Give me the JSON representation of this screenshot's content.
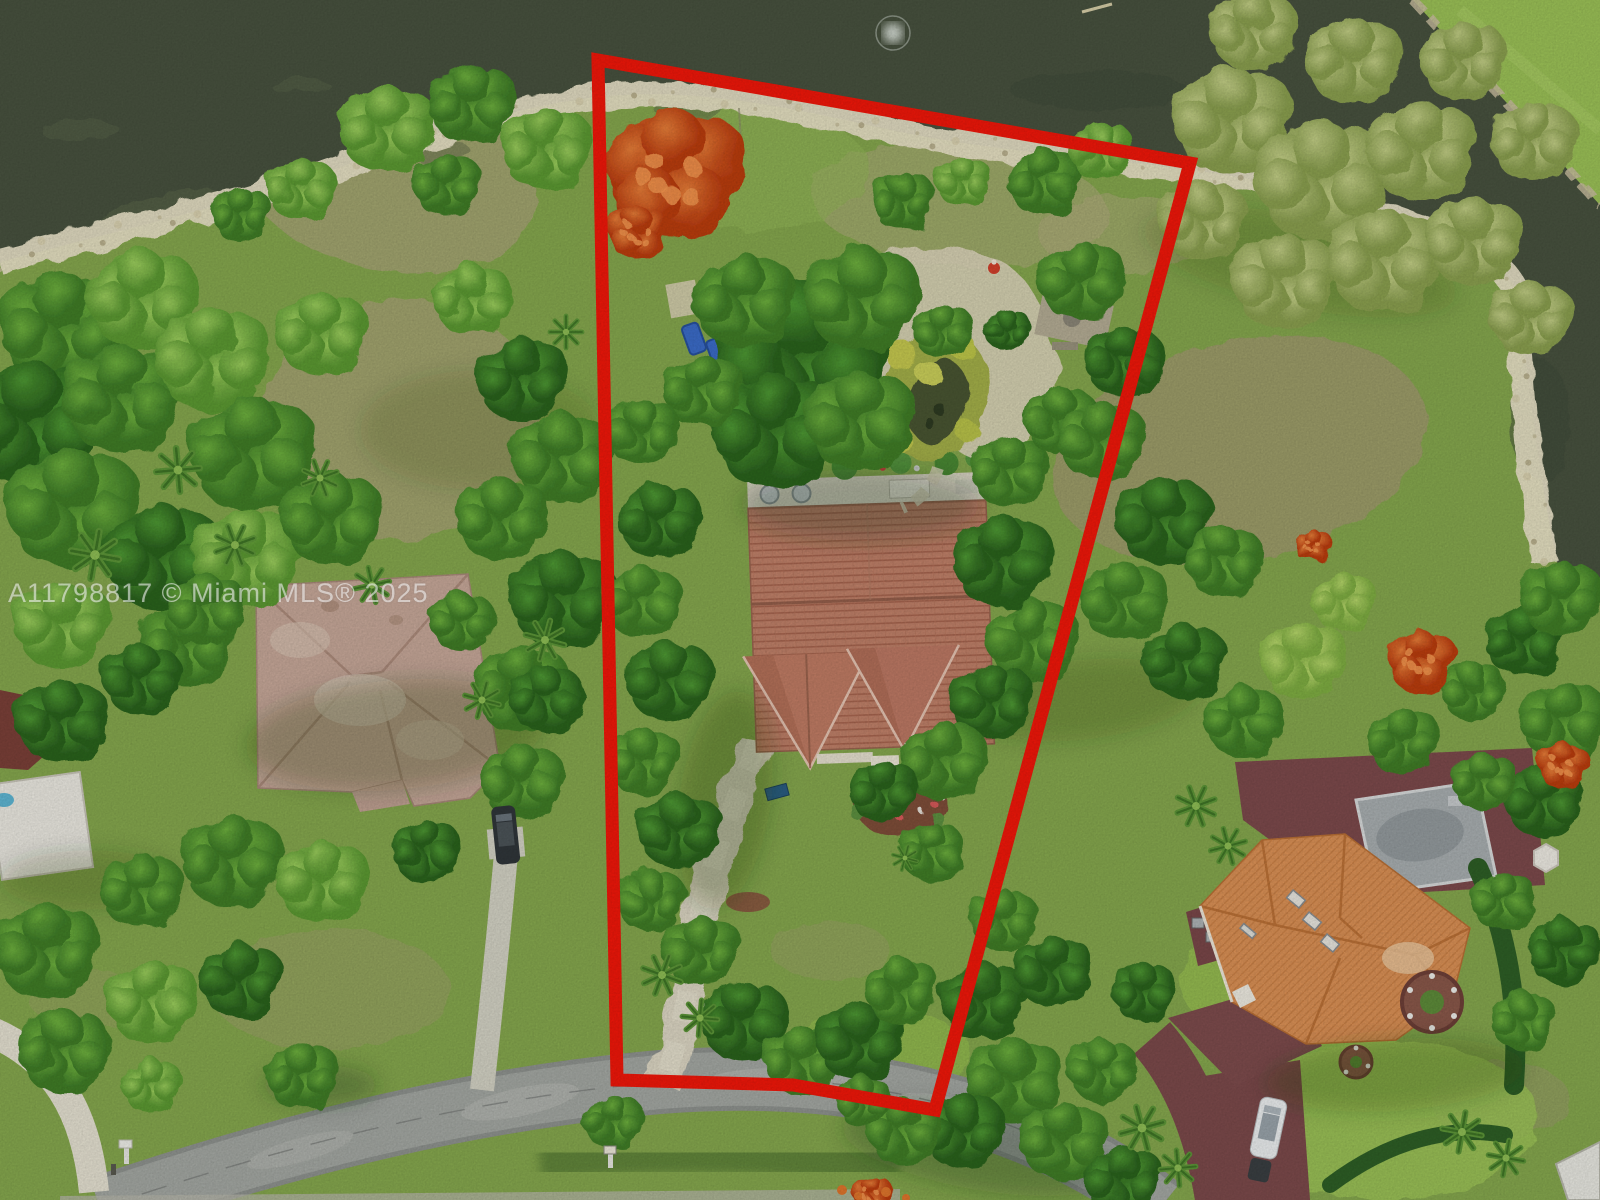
{
  "image": {
    "description": "Aerial drone photo of a pie-shaped residential lot outlined in red, fronting a dark lake at top with a sandy shoreline, a tile-roof house and tropical garden inside the boundary, neighboring homes to the left and lower right, and a curving street along the bottom"
  },
  "watermark": {
    "text": "A11798817 © Miami MLS® 2025",
    "color": "rgba(255,255,255,0.55)"
  },
  "boundary": {
    "points": "598,60 1190,163 935,1110 793,1085 617,1080",
    "color": "#f2170a",
    "stroke_width": 13
  },
  "colors": {
    "water": "#48523f",
    "shore_sand": "#eae3c8",
    "grass": "#86a84e",
    "dry_grass": "#a9a478",
    "road": "#a4a8a3",
    "concrete_drive": "#ddd7c4",
    "maroon_paving": "#7d4a4c",
    "subject_roof": "#c08169",
    "left_roof": "#c7a899",
    "right_roof": "#db9156",
    "boundary_red": "#f2170a",
    "poinciana_orange": "#d4541e"
  },
  "scene": {
    "labels": [
      {
        "name": "lake",
        "description": "dark olive lake across the top with aerator fountain"
      },
      {
        "name": "shoreline",
        "description": "white sandy rocky shoreline strip"
      },
      {
        "name": "subject-lot",
        "description": "red outlined pie-shaped waterfront lot"
      },
      {
        "name": "subject-house",
        "description": "terracotta barrel-tile roof house with two front gables"
      },
      {
        "name": "garden-pond",
        "description": "koi pond with white gravel paths in rear garden"
      },
      {
        "name": "left-house",
        "description": "neighbor house with faded pink hip roof"
      },
      {
        "name": "right-house",
        "description": "neighbor house with bright orange tile roof, flat gray roof and maroon pavers"
      },
      {
        "name": "street",
        "description": "gray asphalt road curving along the bottom"
      },
      {
        "name": "white-car",
        "description": "white car on maroon driveway lower right"
      },
      {
        "name": "dark-car",
        "description": "dark car on left neighbor driveway"
      }
    ],
    "trees": [
      [
        60,
        330,
        55,
        2
      ],
      [
        140,
        300,
        48,
        3
      ],
      [
        30,
        425,
        60,
        1
      ],
      [
        120,
        400,
        52,
        2
      ],
      [
        210,
        360,
        50,
        3
      ],
      [
        70,
        510,
        58,
        2
      ],
      [
        160,
        560,
        52,
        1
      ],
      [
        250,
        455,
        55,
        2
      ],
      [
        245,
        560,
        48,
        3
      ],
      [
        330,
        520,
        44,
        2
      ],
      [
        320,
        335,
        40,
        3
      ],
      [
        185,
        645,
        40,
        2
      ],
      [
        60,
        625,
        42,
        3
      ],
      [
        385,
        130,
        42,
        3
      ],
      [
        470,
        105,
        38,
        2
      ],
      [
        545,
        150,
        40,
        3
      ],
      [
        300,
        190,
        30,
        3
      ],
      [
        240,
        215,
        26,
        2
      ],
      [
        445,
        185,
        30,
        2
      ],
      [
        520,
        380,
        40,
        1
      ],
      [
        560,
        460,
        44,
        2
      ],
      [
        500,
        520,
        40,
        2
      ],
      [
        560,
        600,
        46,
        1
      ],
      [
        520,
        690,
        42,
        2
      ],
      [
        470,
        300,
        34,
        3
      ],
      [
        205,
        610,
        34,
        2
      ],
      [
        140,
        680,
        34,
        1
      ],
      [
        230,
        862,
        44,
        2
      ],
      [
        320,
        882,
        40,
        3
      ],
      [
        140,
        892,
        36,
        2
      ],
      [
        425,
        852,
        30,
        1
      ],
      [
        520,
        782,
        36,
        2
      ],
      [
        545,
        700,
        32,
        1
      ],
      [
        460,
        622,
        28,
        2
      ],
      [
        60,
        722,
        40,
        1
      ],
      [
        45,
        952,
        46,
        2
      ],
      [
        150,
        1002,
        40,
        3
      ],
      [
        62,
        1052,
        40,
        2
      ],
      [
        240,
        982,
        36,
        1
      ],
      [
        300,
        1076,
        32,
        2
      ],
      [
        150,
        1086,
        26,
        3
      ],
      [
        800,
        360,
        75,
        1
      ],
      [
        860,
        300,
        50,
        2
      ],
      [
        742,
        302,
        45,
        2
      ],
      [
        772,
        432,
        55,
        1
      ],
      [
        858,
        422,
        48,
        2
      ],
      [
        702,
        392,
        35,
        2
      ],
      [
        640,
        432,
        32,
        2
      ],
      [
        658,
        522,
        36,
        1
      ],
      [
        640,
        602,
        34,
        2
      ],
      [
        668,
        682,
        38,
        1
      ],
      [
        642,
        762,
        32,
        2
      ],
      [
        678,
        832,
        36,
        1
      ],
      [
        650,
        902,
        30,
        2
      ],
      [
        700,
        952,
        34,
        2
      ],
      [
        742,
        1022,
        38,
        1
      ],
      [
        800,
        1062,
        34,
        2
      ],
      [
        858,
        1042,
        38,
        1
      ],
      [
        900,
        992,
        32,
        2
      ],
      [
        1000,
        562,
        44,
        1
      ],
      [
        1030,
        642,
        40,
        2
      ],
      [
        990,
        702,
        36,
        1
      ],
      [
        942,
        762,
        38,
        2
      ],
      [
        1008,
        472,
        34,
        2
      ],
      [
        882,
        792,
        30,
        1
      ],
      [
        930,
        852,
        28,
        2
      ],
      [
        1080,
        282,
        38,
        2
      ],
      [
        1122,
        362,
        34,
        1
      ],
      [
        1060,
        422,
        32,
        2
      ],
      [
        902,
        202,
        28,
        2
      ],
      [
        962,
        182,
        24,
        3
      ],
      [
        1042,
        182,
        32,
        2
      ],
      [
        1100,
        152,
        28,
        3
      ],
      [
        942,
        332,
        26,
        2
      ],
      [
        1006,
        330,
        20,
        1
      ],
      [
        1230,
        122,
        52,
        5
      ],
      [
        1320,
        182,
        58,
        5
      ],
      [
        1420,
        152,
        48,
        5
      ],
      [
        1282,
        282,
        46,
        5
      ],
      [
        1382,
        262,
        50,
        5
      ],
      [
        1472,
        242,
        42,
        5
      ],
      [
        1252,
        32,
        38,
        5
      ],
      [
        1352,
        62,
        42,
        5
      ],
      [
        1462,
        62,
        38,
        5
      ],
      [
        1532,
        142,
        38,
        5
      ],
      [
        1202,
        222,
        38,
        5
      ],
      [
        1530,
        320,
        36,
        5
      ],
      [
        1100,
        442,
        38,
        2
      ],
      [
        1162,
        522,
        42,
        1
      ],
      [
        1122,
        602,
        38,
        2
      ],
      [
        1222,
        562,
        34,
        2
      ],
      [
        1182,
        662,
        36,
        1
      ],
      [
        1302,
        662,
        38,
        4
      ],
      [
        1342,
        602,
        28,
        4
      ],
      [
        1242,
        722,
        34,
        2
      ],
      [
        1402,
        742,
        32,
        2
      ],
      [
        1472,
        692,
        28,
        2
      ],
      [
        1522,
        642,
        34,
        1
      ],
      [
        1562,
        722,
        38,
        2
      ],
      [
        1542,
        802,
        34,
        1
      ],
      [
        1482,
        782,
        28,
        2
      ],
      [
        1560,
        600,
        36,
        2
      ],
      [
        982,
        1002,
        38,
        1
      ],
      [
        1012,
        1082,
        42,
        2
      ],
      [
        962,
        1132,
        36,
        1
      ],
      [
        1062,
        1142,
        38,
        2
      ],
      [
        1122,
        1182,
        34,
        1
      ],
      [
        902,
        1132,
        32,
        2
      ],
      [
        1502,
        902,
        28,
        2
      ],
      [
        1562,
        952,
        32,
        1
      ],
      [
        1522,
        1022,
        28,
        2
      ],
      [
        1002,
        922,
        30,
        2
      ],
      [
        1052,
        972,
        34,
        1
      ],
      [
        612,
        1122,
        26,
        2
      ],
      [
        1102,
        1072,
        30,
        2
      ],
      [
        1142,
        992,
        28,
        1
      ],
      [
        862,
        1102,
        24,
        2
      ]
    ],
    "palms": [
      [
        95,
        555,
        1.2,
        10
      ],
      [
        178,
        470,
        1.1,
        40
      ],
      [
        235,
        545,
        1.0,
        -20
      ],
      [
        320,
        478,
        0.9,
        70
      ],
      [
        545,
        640,
        1.0,
        15
      ],
      [
        482,
        700,
        0.9,
        -30
      ],
      [
        662,
        975,
        1.0,
        20
      ],
      [
        700,
        1018,
        0.9,
        -40
      ],
      [
        1196,
        806,
        1.0,
        25
      ],
      [
        1228,
        846,
        0.9,
        -15
      ],
      [
        1142,
        1128,
        1.1,
        30
      ],
      [
        1178,
        1168,
        0.9,
        -50
      ],
      [
        1462,
        1132,
        1.0,
        10
      ],
      [
        1506,
        1158,
        0.9,
        55
      ],
      [
        905,
        858,
        0.62,
        15
      ],
      [
        566,
        332,
        0.8,
        0
      ],
      [
        372,
        585,
        0.9,
        33
      ]
    ],
    "poincianas": [
      [
        672,
        175,
        62
      ],
      [
        636,
        232,
        26
      ],
      [
        1420,
        662,
        30
      ],
      [
        1312,
        546,
        16
      ],
      [
        1562,
        766,
        22
      ],
      [
        872,
        1196,
        18
      ]
    ]
  }
}
